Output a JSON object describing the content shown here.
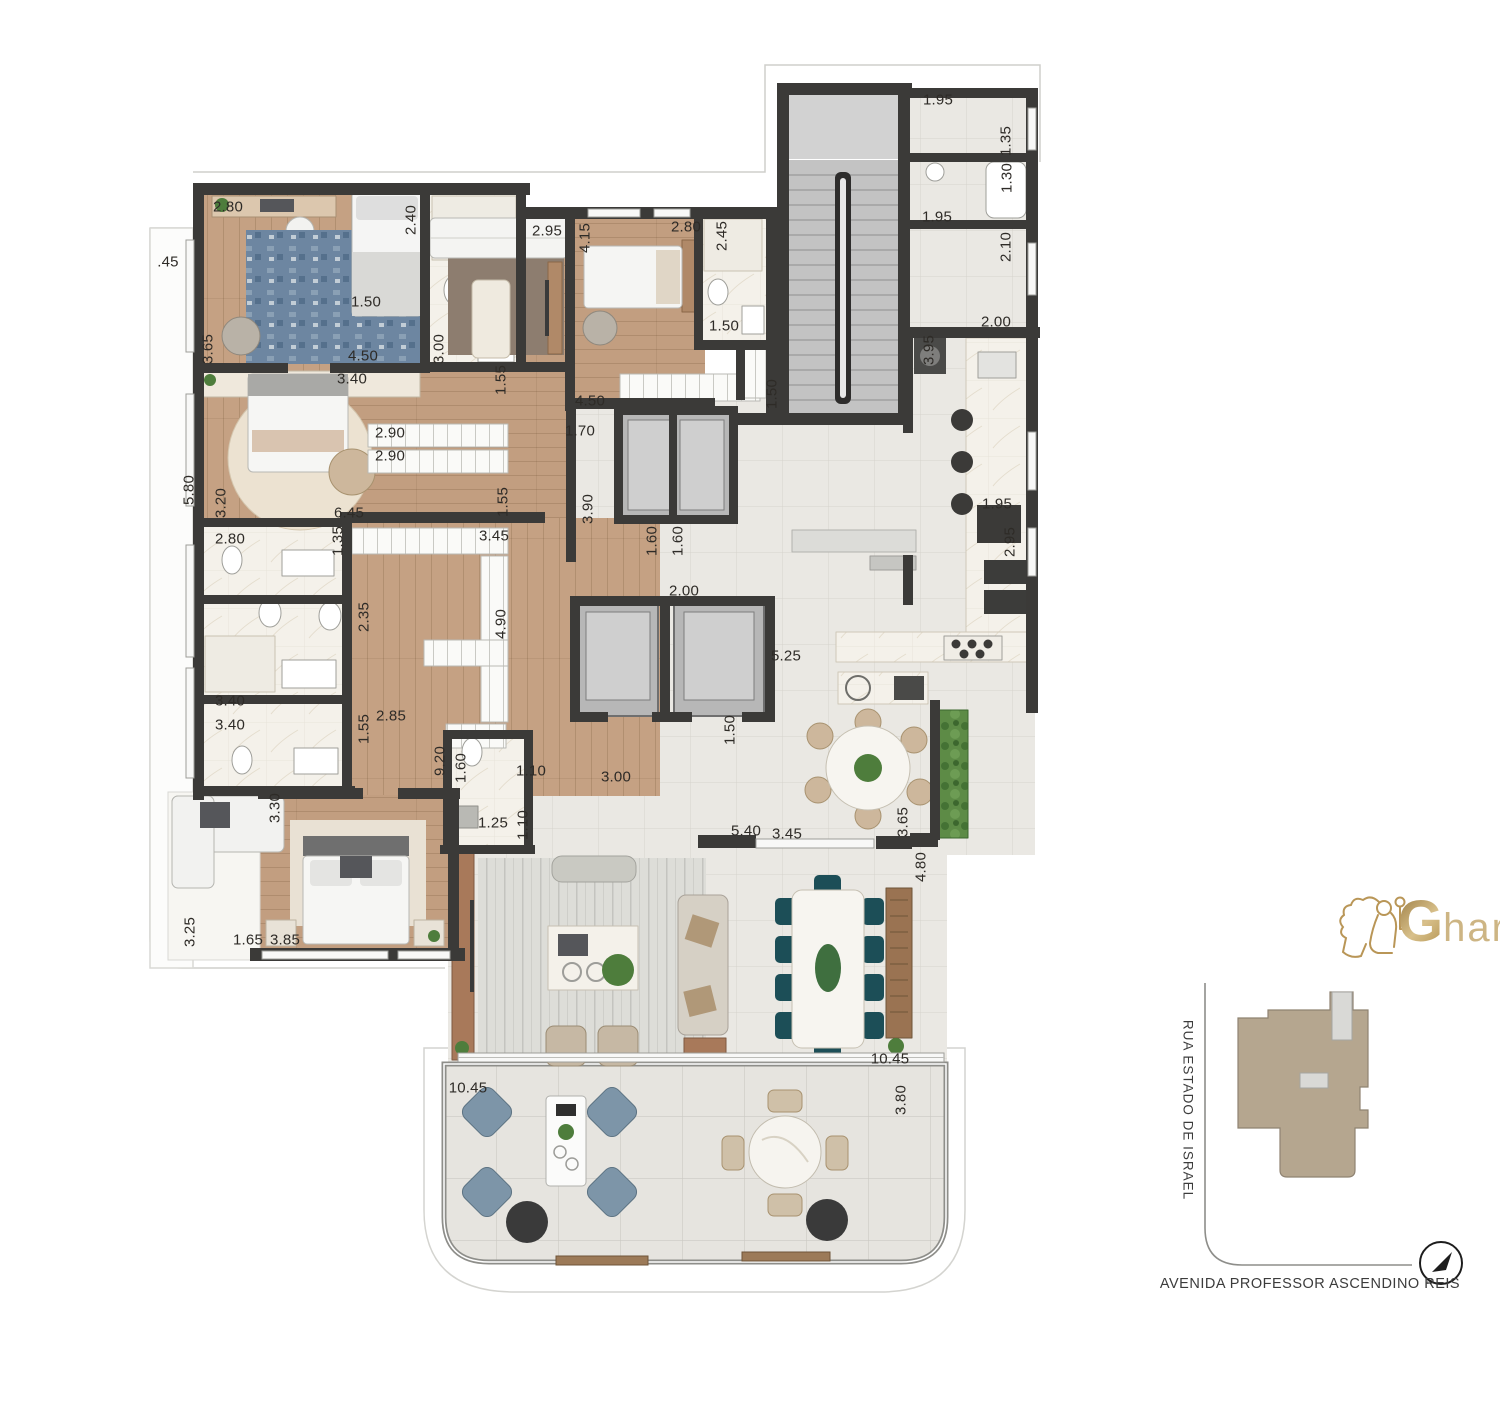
{
  "logo": {
    "g": "G",
    "rest": "har"
  },
  "map": {
    "street_left": "RUA ESTADO DE ISRAEL",
    "street_bottom": "AVENIDA PROFESSOR ASCENDINO REIS",
    "compass_n": "N"
  },
  "colors": {
    "wall": "#3b3a38",
    "wood": "#c5a183",
    "tile": "#eae8e3",
    "marble": "#f4f1ea",
    "stair": "#c3c3c3",
    "gold": "#bfa05f",
    "map_building": "#b5a68f",
    "dining_chair": "#1c4e57",
    "terrace_chair": "#7d95a8",
    "plant": "#4e7d3c"
  },
  "measurements": [
    {
      "t": ".45",
      "x": 168,
      "y": 262,
      "r": 0
    },
    {
      "t": "2.80",
      "x": 228,
      "y": 207,
      "r": 0
    },
    {
      "t": "2.40",
      "x": 411,
      "y": 220,
      "r": 1
    },
    {
      "t": "2.95",
      "x": 547,
      "y": 231,
      "r": 0
    },
    {
      "t": "4.15",
      "x": 585,
      "y": 238,
      "r": 1
    },
    {
      "t": "2.80",
      "x": 686,
      "y": 227,
      "r": 0
    },
    {
      "t": "2.45",
      "x": 722,
      "y": 236,
      "r": 1
    },
    {
      "t": "1.95",
      "x": 938,
      "y": 100,
      "r": 0
    },
    {
      "t": "1.35",
      "x": 1006,
      "y": 141,
      "r": 1
    },
    {
      "t": "1.30",
      "x": 1007,
      "y": 178,
      "r": 1
    },
    {
      "t": "1.95",
      "x": 937,
      "y": 217,
      "r": 0
    },
    {
      "t": "2.10",
      "x": 1006,
      "y": 247,
      "r": 1
    },
    {
      "t": "1.50",
      "x": 366,
      "y": 302,
      "r": 0
    },
    {
      "t": "1.50",
      "x": 724,
      "y": 326,
      "r": 0
    },
    {
      "t": "2.00",
      "x": 996,
      "y": 322,
      "r": 0
    },
    {
      "t": "3.65",
      "x": 208,
      "y": 349,
      "r": 1
    },
    {
      "t": "3.00",
      "x": 439,
      "y": 349,
      "r": 1
    },
    {
      "t": "3.95",
      "x": 929,
      "y": 350,
      "r": 1
    },
    {
      "t": "4.50",
      "x": 363,
      "y": 356,
      "r": 0
    },
    {
      "t": "3.40",
      "x": 352,
      "y": 379,
      "r": 0
    },
    {
      "t": "1.55",
      "x": 501,
      "y": 380,
      "r": 1
    },
    {
      "t": "4.50",
      "x": 590,
      "y": 401,
      "r": 0
    },
    {
      "t": "1.50",
      "x": 772,
      "y": 394,
      "r": 1
    },
    {
      "t": "1.70",
      "x": 580,
      "y": 431,
      "r": 0
    },
    {
      "t": "2.90",
      "x": 390,
      "y": 433,
      "r": 0
    },
    {
      "t": "2.90",
      "x": 390,
      "y": 456,
      "r": 0
    },
    {
      "t": "5.80",
      "x": 189,
      "y": 490,
      "r": 1
    },
    {
      "t": "3.20",
      "x": 221,
      "y": 503,
      "r": 1
    },
    {
      "t": "1.55",
      "x": 503,
      "y": 502,
      "r": 1
    },
    {
      "t": "3.90",
      "x": 588,
      "y": 509,
      "r": 1
    },
    {
      "t": "1.95",
      "x": 997,
      "y": 504,
      "r": 0
    },
    {
      "t": "6.45",
      "x": 349,
      "y": 513,
      "r": 0
    },
    {
      "t": "2.80",
      "x": 230,
      "y": 539,
      "r": 0
    },
    {
      "t": "1.35",
      "x": 338,
      "y": 541,
      "r": 1
    },
    {
      "t": "3.45",
      "x": 494,
      "y": 536,
      "r": 0
    },
    {
      "t": "2.95",
      "x": 1010,
      "y": 542,
      "r": 1
    },
    {
      "t": "1.60",
      "x": 652,
      "y": 541,
      "r": 1
    },
    {
      "t": "1.60",
      "x": 678,
      "y": 541,
      "r": 1
    },
    {
      "t": "2.00",
      "x": 684,
      "y": 591,
      "r": 0
    },
    {
      "t": "2.35",
      "x": 364,
      "y": 617,
      "r": 1
    },
    {
      "t": "4.90",
      "x": 501,
      "y": 624,
      "r": 1
    },
    {
      "t": "5.25",
      "x": 786,
      "y": 656,
      "r": 0
    },
    {
      "t": "3.40",
      "x": 230,
      "y": 701,
      "r": 0
    },
    {
      "t": "3.40",
      "x": 230,
      "y": 725,
      "r": 0
    },
    {
      "t": "2.85",
      "x": 391,
      "y": 716,
      "r": 0
    },
    {
      "t": "1.55",
      "x": 364,
      "y": 729,
      "r": 1
    },
    {
      "t": "1.50",
      "x": 730,
      "y": 730,
      "r": 1
    },
    {
      "t": "9.20",
      "x": 440,
      "y": 761,
      "r": 1
    },
    {
      "t": "1.60",
      "x": 461,
      "y": 768,
      "r": 1
    },
    {
      "t": "1.10",
      "x": 531,
      "y": 771,
      "r": 0
    },
    {
      "t": "3.00",
      "x": 616,
      "y": 777,
      "r": 0
    },
    {
      "t": "3.30",
      "x": 275,
      "y": 808,
      "r": 1
    },
    {
      "t": "1.25",
      "x": 493,
      "y": 823,
      "r": 0
    },
    {
      "t": "1.10",
      "x": 523,
      "y": 825,
      "r": 1
    },
    {
      "t": "5.40",
      "x": 746,
      "y": 831,
      "r": 0
    },
    {
      "t": "3.45",
      "x": 787,
      "y": 834,
      "r": 0
    },
    {
      "t": "3.65",
      "x": 903,
      "y": 822,
      "r": 1
    },
    {
      "t": "4.80",
      "x": 921,
      "y": 867,
      "r": 1
    },
    {
      "t": "3.25",
      "x": 190,
      "y": 932,
      "r": 1
    },
    {
      "t": "1.65",
      "x": 248,
      "y": 940,
      "r": 0
    },
    {
      "t": "3.85",
      "x": 285,
      "y": 940,
      "r": 0
    },
    {
      "t": "10.45",
      "x": 890,
      "y": 1059,
      "r": 0
    },
    {
      "t": "10.45",
      "x": 468,
      "y": 1088,
      "r": 0
    },
    {
      "t": "3.80",
      "x": 901,
      "y": 1100,
      "r": 1
    }
  ]
}
